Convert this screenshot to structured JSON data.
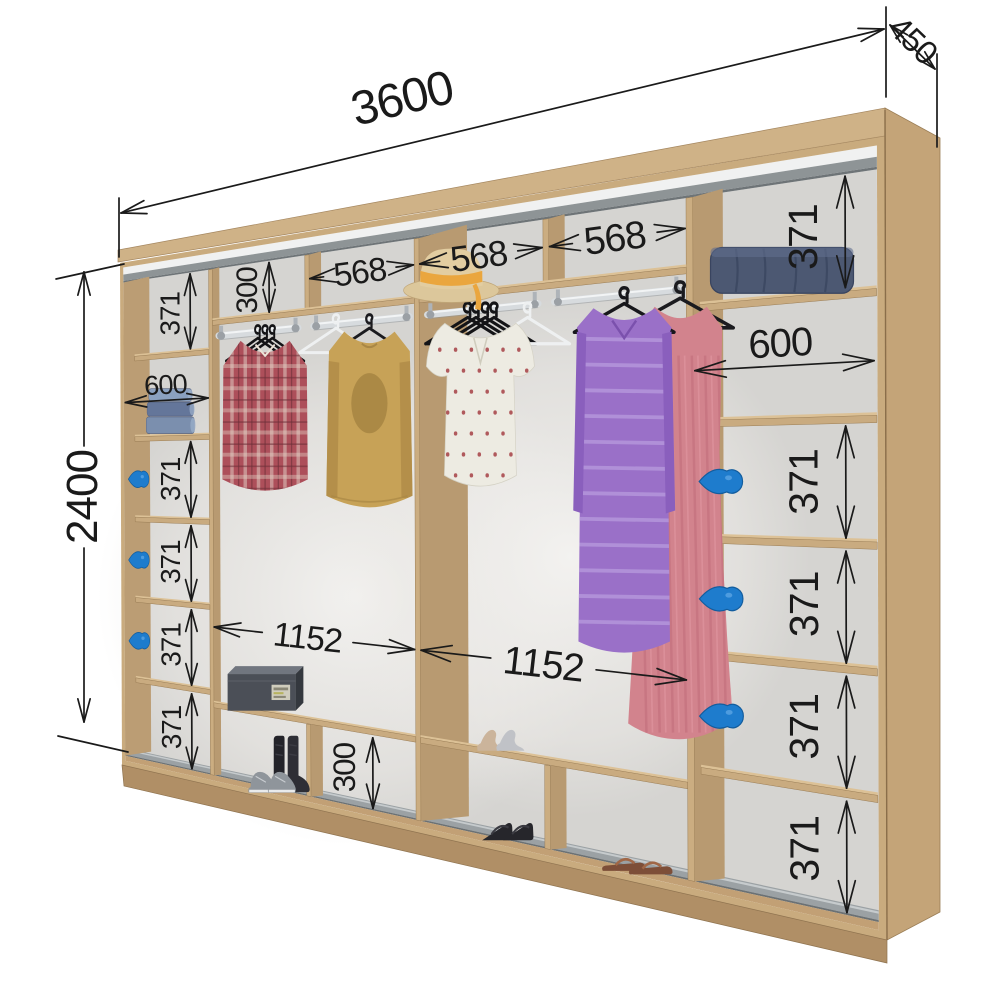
{
  "diagram": {
    "type": "wardrobe-interior-dimension-diagram",
    "overall_dimensions": {
      "width": "3600",
      "depth": "450",
      "height": "2400"
    },
    "inner_dimensions": [
      {
        "id": "left-col-cell-1",
        "text": "371",
        "kind": "v",
        "ax": 500,
        "tx": 360,
        "y1": 102,
        "y2": 441
      },
      {
        "id": "left-col-width",
        "text": "600",
        "kind": "h",
        "x1": 36,
        "x2": 618,
        "y": 668,
        "ty": 596
      },
      {
        "id": "left-col-cell-3",
        "text": "371",
        "kind": "v",
        "ax": 500,
        "tx": 360,
        "y1": 862,
        "y2": 1203
      },
      {
        "id": "left-col-cell-4",
        "text": "371",
        "kind": "v",
        "ax": 500,
        "tx": 360,
        "y1": 1243,
        "y2": 1584
      },
      {
        "id": "left-col-cell-5",
        "text": "371",
        "kind": "v",
        "ax": 500,
        "tx": 360,
        "y1": 1624,
        "y2": 1965
      },
      {
        "id": "left-col-cell-6",
        "text": "371",
        "kind": "v",
        "ax": 500,
        "tx": 360,
        "y1": 2005,
        "y2": 2344
      },
      {
        "id": "mid-left-top-height",
        "text": "300",
        "kind": "v",
        "ax": 1005,
        "tx": 868,
        "y1": 104,
        "y2": 316
      },
      {
        "id": "mid-left-top-width",
        "text": "568",
        "kind": "ho",
        "x1": 1244,
        "x2": 1796,
        "y": 196
      },
      {
        "id": "mid-left-width",
        "text": "1152",
        "kind": "hg",
        "x1": 652,
        "x2": 1796,
        "y": 1690
      },
      {
        "id": "mid-left-bottom-height",
        "text": "300",
        "kind": "v",
        "ax": 1580,
        "tx": 1428,
        "y1": 2062,
        "y2": 2344
      },
      {
        "id": "mid-right-top-width-1",
        "text": "568",
        "kind": "ho",
        "x1": 1828,
        "x2": 2388,
        "y": 196
      },
      {
        "id": "mid-right-top-width-2",
        "text": "568",
        "kind": "ho",
        "x1": 2420,
        "x2": 2948,
        "y": 196
      },
      {
        "id": "mid-right-width",
        "text": "1152",
        "kind": "hg",
        "x1": 1828,
        "x2": 2948,
        "y": 1690
      },
      {
        "id": "right-col-cell-1",
        "text": "371",
        "kind": "v",
        "ax": 3480,
        "tx": 3348,
        "y1": 102,
        "y2": 441
      },
      {
        "id": "right-col-width",
        "text": "600",
        "kind": "h",
        "x1": 2982,
        "x2": 3566,
        "y": 668,
        "ty": 596
      },
      {
        "id": "right-col-cell-3",
        "text": "371",
        "kind": "v",
        "ax": 3480,
        "tx": 3348,
        "y1": 862,
        "y2": 1203
      },
      {
        "id": "right-col-cell-4",
        "text": "371",
        "kind": "v",
        "ax": 3480,
        "tx": 3348,
        "y1": 1243,
        "y2": 1584
      },
      {
        "id": "right-col-cell-5",
        "text": "371",
        "kind": "v",
        "ax": 3480,
        "tx": 3348,
        "y1": 1624,
        "y2": 1965
      },
      {
        "id": "right-col-cell-6",
        "text": "371",
        "kind": "v",
        "ax": 3480,
        "tx": 3348,
        "y1": 2005,
        "y2": 2344
      }
    ],
    "colors": {
      "wood": "#c9ab7e",
      "wood_dark": "#b3946b",
      "wood_light": "#dcc196",
      "back_panel": "#d5d4d1",
      "track_grey": "#8e9496",
      "rail_grey": "#9ba1a4",
      "handle_blue": "#1e7ccd",
      "dimension_text": "#1a1a1a"
    },
    "props": [
      "hanging-rod",
      "clothes-hanger",
      "empty-white-hanger",
      "plaid-shirt",
      "mustard-sweater",
      "polka-dot-blouse",
      "purple-striped-dress",
      "pink-dress",
      "straw-hat",
      "folded-jeans",
      "folded-blanket",
      "shoe-box",
      "ankle-boots",
      "sneakers",
      "beige-heels",
      "silver-heels",
      "black-wedge-sandals",
      "brown-sandals",
      "blue-door-handle"
    ]
  }
}
